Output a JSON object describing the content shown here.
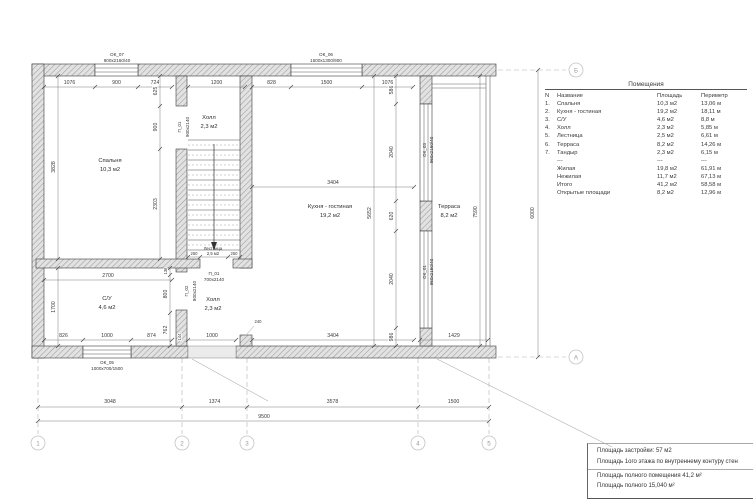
{
  "plan": {
    "rooms": [
      {
        "name": "Спальня",
        "area": "10,3 м2"
      },
      {
        "name": "Холл",
        "area": "2,3 м2"
      },
      {
        "name": "Кухня - гостиная",
        "area": "19,2 м2"
      },
      {
        "name": "С/У",
        "area": "4,6 м2"
      },
      {
        "name": "Холл",
        "area": "2,3 м2"
      },
      {
        "name": "Терраса",
        "area": "8,2 м2"
      },
      {
        "name": "Лестница",
        "area": "2,5 м2"
      }
    ],
    "openings": {
      "ok07": {
        "id": "ОК_07",
        "size": "900х2160/40"
      },
      "ok06": {
        "id": "ОК_06",
        "size": "1500х1300/900"
      },
      "ok05": {
        "id": "ОК_05",
        "size": "1000х700/1500"
      },
      "ok03": {
        "id": "ОК_03",
        "size": "960х2160/40"
      },
      "ok01": {
        "id": "ОК_01",
        "size": "960х2160/40"
      },
      "p01a": {
        "id": "П_01",
        "size": "900х2140"
      },
      "p01b": {
        "id": "П_01",
        "size": "700х2140"
      },
      "p02": {
        "id": "П_02",
        "size": "800х2140"
      }
    },
    "dims": {
      "top": [
        "1076",
        "900",
        "724",
        "1200",
        "828",
        "1500",
        "1076"
      ],
      "bedroom_left": "3828",
      "bedroom_right": [
        "625",
        "900",
        "2303"
      ],
      "su_left": "1700",
      "su_top": "2700",
      "su_right": [
        "138",
        "800",
        "762"
      ],
      "stairs": [
        "250",
        "250"
      ],
      "kitchen_top": "3404",
      "kitchen_height": "5652",
      "wall_chain": [
        "586",
        "2040",
        "620",
        "2040",
        "986"
      ],
      "terrace_height": "7590",
      "bottom_inner": [
        "826",
        "1000",
        "874",
        "144",
        "1000"
      ],
      "kitchen_bottom": "3404",
      "stub": "240",
      "terrace_bottom": "1429",
      "row1": [
        "3048",
        "1374",
        "3578",
        "1500"
      ],
      "total_width": "9500",
      "total_height": "6000"
    },
    "grid": {
      "cols": [
        "1",
        "2",
        "3",
        "4",
        "5"
      ],
      "rowA": "А",
      "rowB": "Б"
    }
  },
  "table": {
    "title": "Помещения",
    "headers": {
      "num": "N",
      "name": "Название",
      "area": "Площадь",
      "perimeter": "Периметр"
    },
    "rows": [
      {
        "num": "1.",
        "name": "Спальня",
        "area": "10,3 м2",
        "perimeter": "13,06 м"
      },
      {
        "num": "2.",
        "name": "Кухня - гостиная",
        "area": "19,2 м2",
        "perimeter": "18,11 м"
      },
      {
        "num": "3.",
        "name": "С/У",
        "area": "4,6 м2",
        "perimeter": "8,8 м"
      },
      {
        "num": "4.",
        "name": "Холл",
        "area": "2,3 м2",
        "perimeter": "5,85 м"
      },
      {
        "num": "5.",
        "name": "Лестница",
        "area": "2,5 м2",
        "perimeter": "6,61 м"
      },
      {
        "num": "6.",
        "name": "Терраса",
        "area": "8,2 м2",
        "perimeter": "14,26 м"
      },
      {
        "num": "7.",
        "name": "Тандыр",
        "area": "2,3 м2",
        "perimeter": "6,15 м"
      },
      {
        "num": "",
        "name": "---",
        "area": "---",
        "perimeter": "---"
      },
      {
        "num": "",
        "name": "Жилая",
        "area": "19,8 м2",
        "perimeter": "61,91 м"
      },
      {
        "num": "",
        "name": "Нежилая",
        "area": "11,7 м2",
        "perimeter": "67,13 м"
      },
      {
        "num": "",
        "name": "Итого",
        "area": "41,2 м2",
        "perimeter": "58,58 м"
      },
      {
        "num": "",
        "name": "Открытые площади",
        "area": "8,2 м2",
        "perimeter": "12,96 м"
      }
    ]
  },
  "notes": {
    "line1": "Площадь застройки: 57 м2",
    "line2": "Площадь 1ого этажа по внутреннему контуру стен",
    "line3": "Площадь полного помещения 41,2 м²",
    "line4": "Площадь полного 15,040 м²"
  }
}
